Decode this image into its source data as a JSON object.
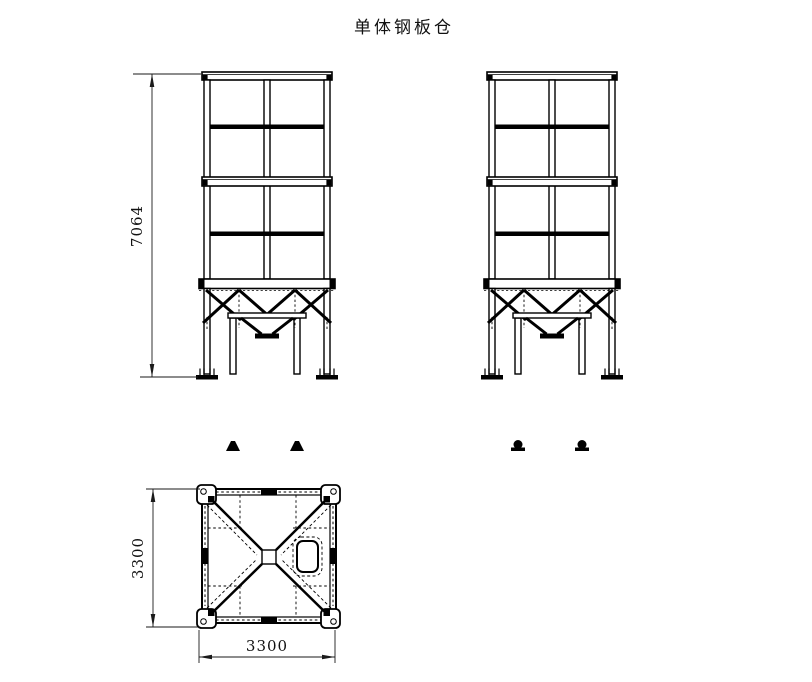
{
  "title": "单体钢板仓",
  "dimensions": {
    "overall_height": "7064",
    "plan_depth": "3300",
    "plan_width": "3300"
  },
  "line_colors": {
    "main": "#000000",
    "dim": "#1a1a1a"
  }
}
